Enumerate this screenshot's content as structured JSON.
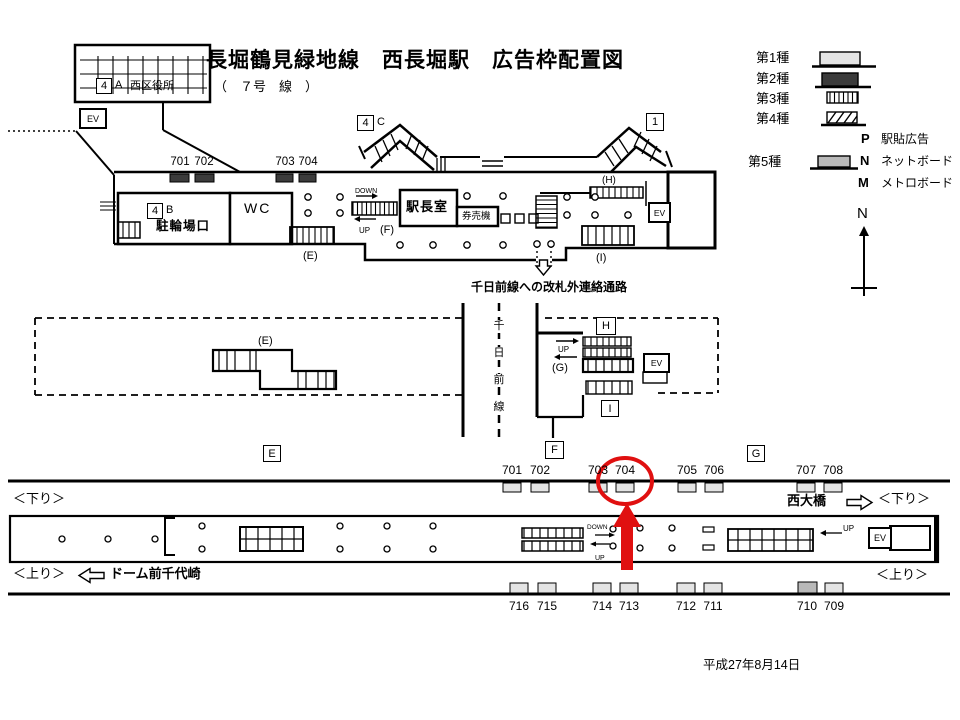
{
  "title": {
    "main": "長堀鶴見緑地線　西長堀駅　広告枠配置図",
    "sub": "（　７号　線　）"
  },
  "legend": {
    "type1": "第1種",
    "type2": "第2種",
    "type3": "第3種",
    "type4": "第4種",
    "type5": "第5種",
    "p_label": "P",
    "p_text": "駅貼広告",
    "n_label": "N",
    "n_text": "ネットボード",
    "m_label": "M",
    "m_text": "メトロボード",
    "compass": "N"
  },
  "concourse": {
    "exit4a_num": "4",
    "exit4a_letter": "A",
    "ward_office": "西区役所",
    "exit4b_num": "4",
    "exit4b_letter": "B",
    "bike_entrance": "駐輪場口",
    "exit4c_num": "4",
    "exit4c_letter": "C",
    "exit1": "1",
    "ev": "EV",
    "wc": "WC",
    "office": "駅長室",
    "ticket": "券売機",
    "down": "DOWN",
    "up": "UP",
    "label_e": "(E)",
    "label_f": "(F)",
    "label_h": "(H)",
    "label_i": "(I)",
    "ads": [
      "701",
      "702",
      "703",
      "704"
    ],
    "passage": "千日前線への改札外連絡通路"
  },
  "mezzanine": {
    "chars": [
      "千",
      "日",
      "前",
      "線"
    ],
    "box_h": "H",
    "box_i": "I",
    "box_e": "E",
    "box_f": "F",
    "box_g": "G",
    "ev": "EV",
    "up": "UP",
    "label_g": "(G)",
    "label_e": "(E)"
  },
  "platform": {
    "dir_down": "＜下り＞",
    "dir_up": "＜上り＞",
    "next_station_right": "西大橋",
    "next_station_left": "ドーム前千代崎",
    "down": "DOWN",
    "up": "UP",
    "up2": "UP",
    "ev": "EV",
    "top_numbers": [
      "701",
      "702",
      "703",
      "704",
      "705",
      "706",
      "707",
      "708"
    ],
    "bottom_numbers": [
      "716",
      "715",
      "714",
      "713",
      "712",
      "711",
      "710",
      "709"
    ]
  },
  "date": "平成27年8月14日",
  "colors": {
    "type1": "#e4e4e4",
    "type2": "#3b3b3b",
    "type5": "#b9b9b9",
    "highlight": "#e01010"
  }
}
